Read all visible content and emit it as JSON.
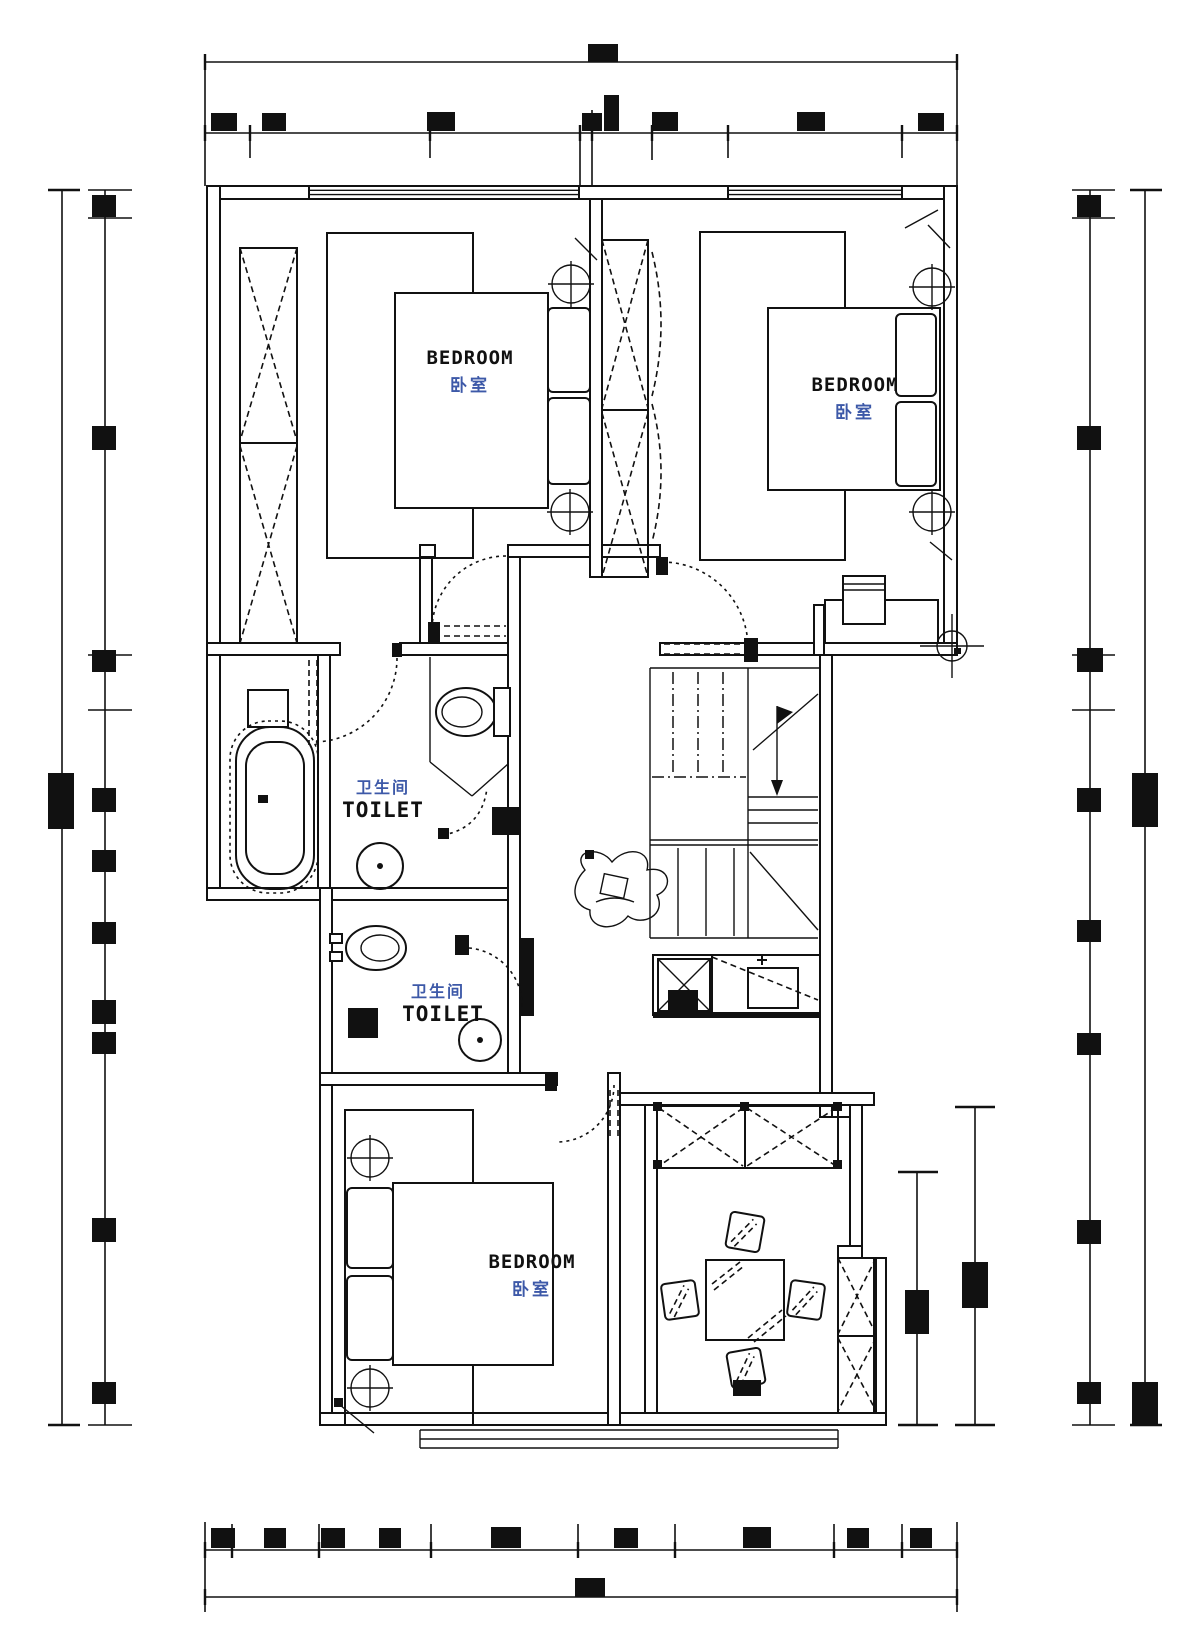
{
  "drawing": {
    "type": "residential floor plan",
    "palette": {
      "line": "#111111",
      "paper": "#ffffff",
      "cjk_text": "#3d59a8"
    }
  },
  "rooms": {
    "bedroom_top_left": {
      "label_en": "BEDROOM",
      "label_zh": "卧室"
    },
    "bedroom_top_right": {
      "label_en": "BEDROOM",
      "label_zh": "卧室"
    },
    "bedroom_bottom": {
      "label_en": "BEDROOM",
      "label_zh": "卧室"
    },
    "toilet_upper": {
      "label_en": "TOILET",
      "label_zh": "卫生间"
    },
    "toilet_lower": {
      "label_en": "TOILET",
      "label_zh": "卫生间"
    }
  }
}
